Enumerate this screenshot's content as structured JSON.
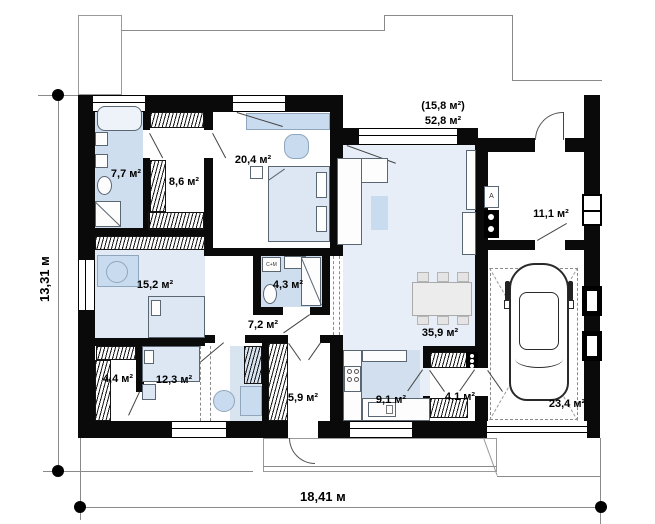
{
  "plan": {
    "rooms": [
      {
        "name": "bathroom-main",
        "label": "7,7 м²"
      },
      {
        "name": "dressing-room",
        "label": "8,6 м²"
      },
      {
        "name": "bedroom-master",
        "label": "20,4 м²"
      },
      {
        "name": "cabinet",
        "label": "15,2 м²"
      },
      {
        "name": "bathroom-small",
        "label": "4,3 м²"
      },
      {
        "name": "hallway",
        "label": "7,2 м²"
      },
      {
        "name": "boiler-room",
        "label": "11,1 м²"
      },
      {
        "name": "wardrobe",
        "label": "4,4 м²"
      },
      {
        "name": "bedroom-second",
        "label": "12,3 м²"
      },
      {
        "name": "entry-hall",
        "label": "5,9 м²"
      },
      {
        "name": "kitchen",
        "label": "9,1 м²"
      },
      {
        "name": "living-dining",
        "label": "35,9 м²"
      },
      {
        "name": "mudroom",
        "label": "4,1 м²"
      },
      {
        "name": "garage",
        "label": "23,4 м²"
      }
    ],
    "terrace": {
      "line1": "(15,8 м²)",
      "line2": "52,8 м²"
    },
    "dimensions": {
      "height": "13,31 м",
      "width": "18,41 м"
    },
    "equipment": {
      "boiler": "A",
      "washer": "С+М"
    },
    "colors": {
      "wall": "#0a0a0a",
      "bath_floor": "#cfdeee",
      "living_floor": "#e7eef7",
      "furniture": "#c9dbee"
    }
  }
}
